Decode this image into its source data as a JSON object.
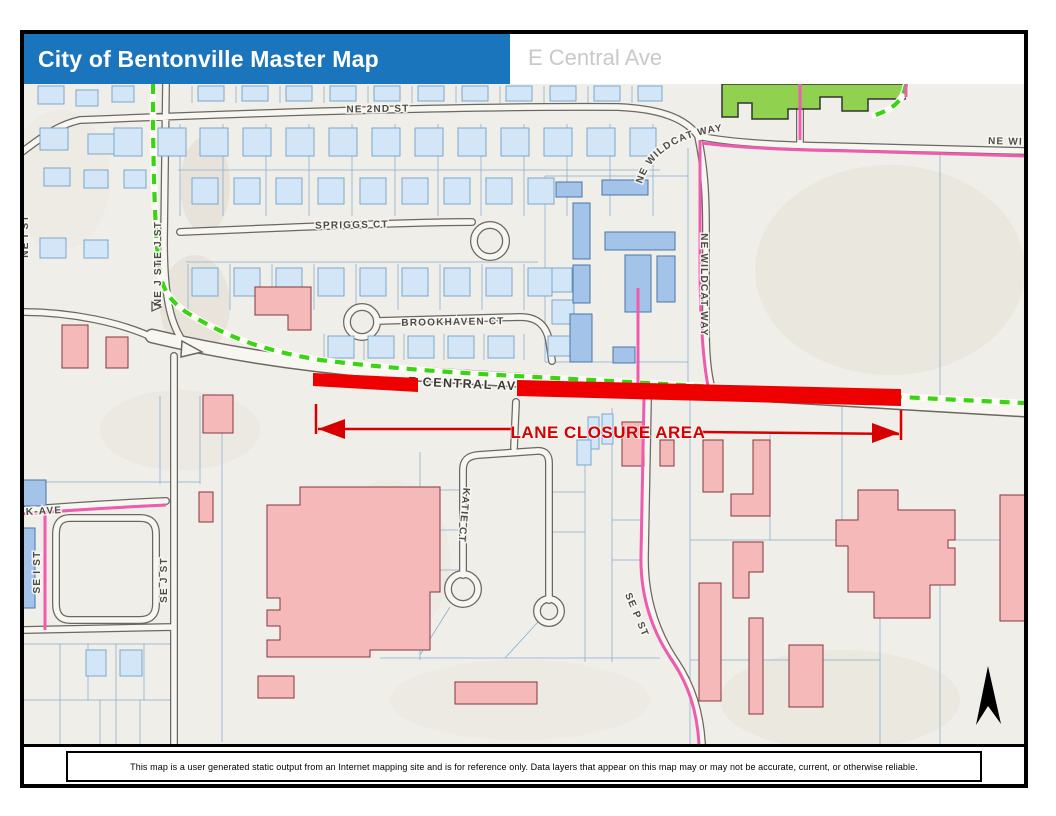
{
  "header": {
    "title": "City of Bentonville Master Map",
    "subtitle": "E Central Ave",
    "title_bg": "#1b75bc",
    "title_color": "#ffffff",
    "subtitle_color": "#c7c9cb"
  },
  "map": {
    "streets": {
      "ne_2nd_st": "NE 2ND ST",
      "spriggs_ct": "SPRIGGS CT",
      "brookhaven_ct": "BROOKHAVEN CT",
      "e_central_ave": "E CENTRAL AVE",
      "ne_wildcat_way": "NE WILDCAT WAY",
      "ne_wildcat_way_clipped": "NE WI",
      "ne_j_st": "NE J ST",
      "ne_i_st": "NE I ST",
      "se_i_st": "SE I ST",
      "se_j_st": "SE J ST",
      "k_ave": "K-AVE",
      "katie_ct": "KATIE CT",
      "se_p_st": "SE P ST"
    },
    "annotations": {
      "lane_closure": "LANE CLOSURE AREA",
      "lane_closure_color": "#d60000",
      "closure_bar_color": "#ee0000"
    },
    "legend_colors": {
      "residential_building": "#d3e6f8",
      "multifamily_building": "#a3c4e8",
      "commercial_building": "#f6b9b9",
      "school_building": "#90d24f",
      "trail_green": "#3bd414",
      "bike_route_pink": "#ee5cb0",
      "road_casing": "#6b6762",
      "parcel_line": "#88b0d4",
      "background": "#f0eee8"
    }
  },
  "footer": {
    "disclaimer": "This map is a user generated static output from an Internet mapping site and is for reference only. Data layers that appear on this map may or may not be accurate, current, or otherwise reliable."
  }
}
